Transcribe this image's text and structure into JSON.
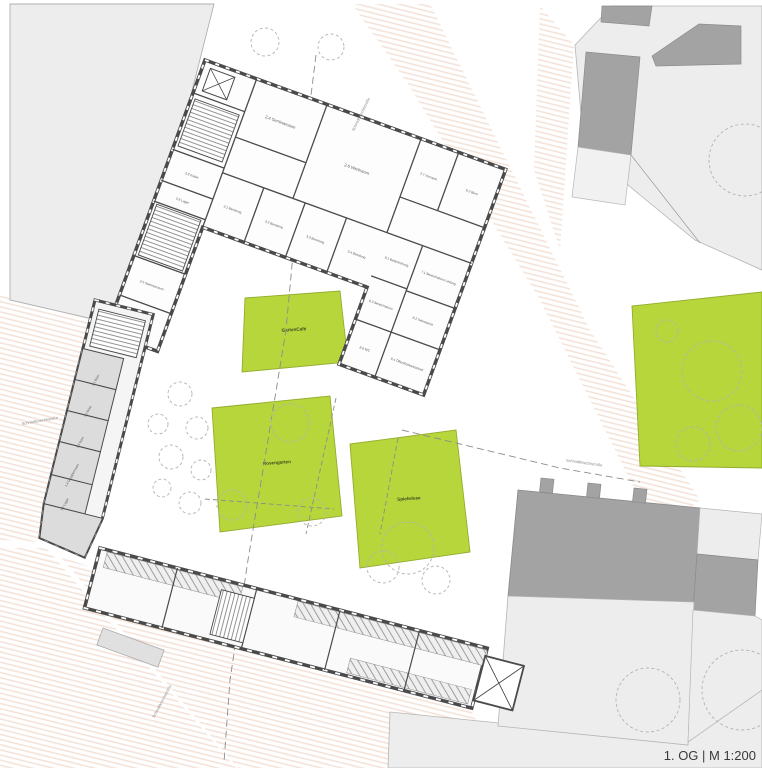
{
  "drawing": {
    "title": "1. OG | M 1:200"
  },
  "street": {
    "label": "Schmidtknechtstraße"
  },
  "gardens": {
    "cafe": "GartenCafé",
    "rose": "Rosengarten",
    "play": "Spielwiese"
  },
  "rooms": {
    "r24": "2.4 Seminarraum",
    "r26": "2.6 Werkraum",
    "r27": "2.7 Vorraum",
    "r62": "6.2 Büro",
    "r31": "3.1 Beratung",
    "r32": "3.2 Beratung",
    "r33": "3.3 Beratung",
    "r34": "3.4 Beratung",
    "r28": "2.8 Kopie",
    "r29": "2.9 Lager",
    "r25": "2.5 Seminarraum",
    "r23": "2.3 Gruppenraum",
    "r81": "8.1 Besprechung",
    "r83": "8.3 Bereichsbüro",
    "r88": "8.8 WC",
    "r71": "7.1 Bereichsbüro Leitung",
    "r82": "8.2 Sekretariat",
    "r84": "8.4 Öffentlichkeitsarbeit",
    "b11": "1.1 Büro",
    "b12": "1.2 Büro",
    "b13": "1.3 Büro",
    "b14": "1.4 Gruppenraum",
    "b15": "1.5 Lager"
  },
  "colors": {
    "garden_green": "#b7d63c",
    "garden_stroke": "#93ad2d",
    "wall_dark": "#4a4a4a",
    "context_roof_dark": "#a3a3a3",
    "context_light": "#ededed",
    "existing_room_gray": "#dcdcdc",
    "street_hatch": "#f3e1d6"
  }
}
